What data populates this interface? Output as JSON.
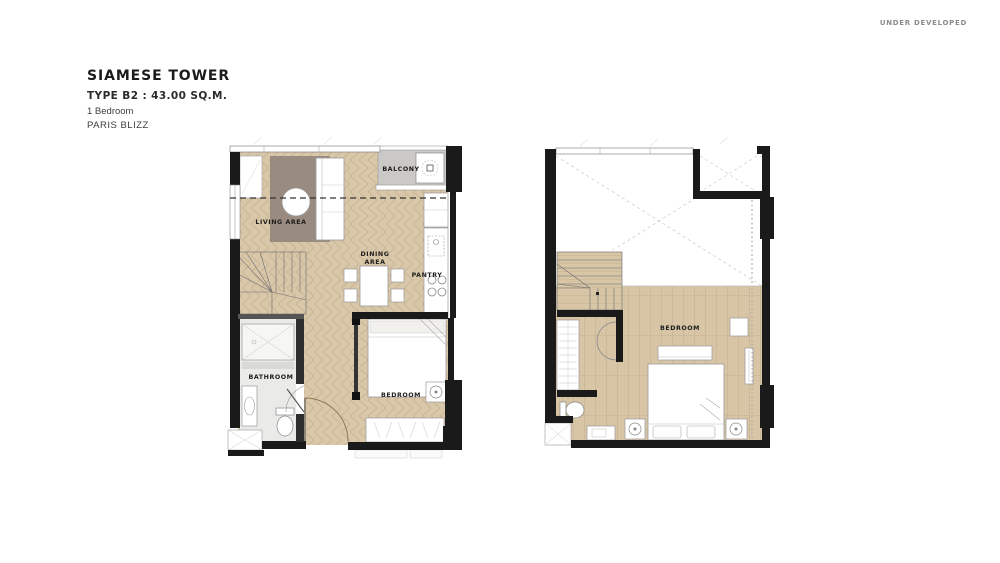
{
  "watermark": "UNDER DEVELOPED",
  "header": {
    "project": "SIAMESE TOWER",
    "unit_type": "TYPE B2 : 43.00 SQ.M.",
    "bedrooms": "1 Bedroom",
    "scheme": "PARIS BLIZZ"
  },
  "floorplan_lower": {
    "balcony": "BALCONY",
    "living": "LIVING AREA",
    "dining_line1": "DINING",
    "dining_line2": "AREA",
    "pantry": "PANTRY",
    "bathroom": "BATHROOM",
    "bedroom": "BEDROOM"
  },
  "floorplan_upper": {
    "bedroom": "BEDROOM"
  },
  "colors": {
    "wall": "#1a1a1a",
    "wood_floor": "#d9c7a9",
    "wood_line": "#c5ae8b",
    "balcony_floor": "#cbc9c6",
    "rug": "#9a8b80",
    "bathroom_floor": "#eaeae8",
    "label_text": "#1c1c1c",
    "watermark_text": "#8c8c8c"
  }
}
